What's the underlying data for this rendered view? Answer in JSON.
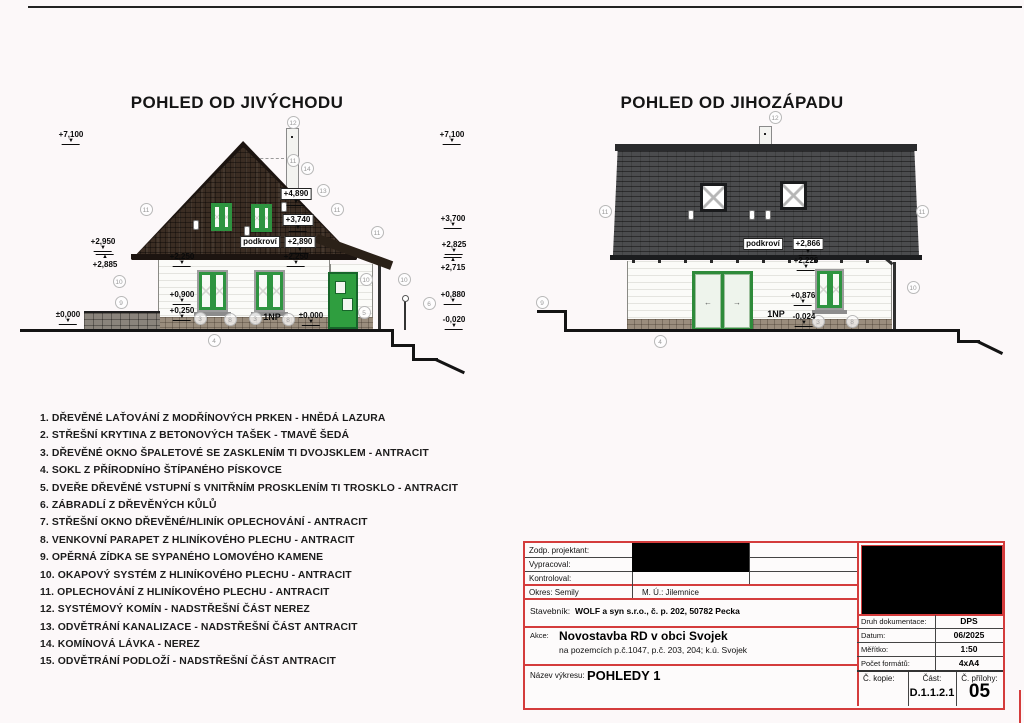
{
  "page": {
    "accent_red": "#d43c3c",
    "roof_brown": "#3b2d23",
    "roof_grey": "#4b4c4e",
    "window_green": "#2e9440"
  },
  "views": {
    "left": {
      "title": "POHLED OD JIVÝCHODU",
      "marks": [
        {
          "t": "+7,100",
          "x": 71,
          "y": 130,
          "d": "down"
        },
        {
          "t": "+7,100",
          "x": 452,
          "y": 130,
          "d": "down"
        },
        {
          "t": "+2,950",
          "x": 103,
          "y": 237,
          "d": "down"
        },
        {
          "t": "+2,885",
          "x": 105,
          "y": 254,
          "d": "up"
        },
        {
          "t": "±0,000",
          "x": 68,
          "y": 310,
          "d": "down"
        },
        {
          "t": "+3,700",
          "x": 453,
          "y": 214,
          "d": "down"
        },
        {
          "t": "+2,825",
          "x": 454,
          "y": 240,
          "d": "down"
        },
        {
          "t": "+2,715",
          "x": 453,
          "y": 257,
          "d": "up"
        },
        {
          "t": "+0,880",
          "x": 453,
          "y": 290,
          "d": "down"
        },
        {
          "t": "-0,020",
          "x": 454,
          "y": 315,
          "d": "down"
        },
        {
          "t": "+4,890",
          "x": 296,
          "y": 188,
          "d": "down",
          "box": 1
        },
        {
          "t": "+3,740",
          "x": 298,
          "y": 214,
          "d": "down",
          "box": 1
        },
        {
          "t": "podkroví",
          "x": 260,
          "y": 236,
          "box": 1
        },
        {
          "t": "+2,890",
          "x": 300,
          "y": 236,
          "d": "down",
          "box": 1
        },
        {
          "t": "+2,250",
          "x": 182,
          "y": 252,
          "d": "down"
        },
        {
          "t": "+2,250",
          "x": 296,
          "y": 252,
          "d": "down"
        },
        {
          "t": "+0,900",
          "x": 182,
          "y": 290,
          "d": "down"
        },
        {
          "t": "+0,250",
          "x": 182,
          "y": 306,
          "d": "down"
        },
        {
          "t": "±0,000",
          "x": 311,
          "y": 311,
          "d": "down"
        },
        {
          "t": "1NP",
          "x": 272,
          "y": 313,
          "bold": 1
        }
      ],
      "circles": [
        {
          "n": 12,
          "x": 293,
          "y": 122
        },
        {
          "n": 11,
          "x": 293,
          "y": 160
        },
        {
          "n": 14,
          "x": 307,
          "y": 168
        },
        {
          "n": 13,
          "x": 323,
          "y": 190
        },
        {
          "n": 11,
          "x": 146,
          "y": 209
        },
        {
          "n": 11,
          "x": 337,
          "y": 209
        },
        {
          "n": 11,
          "x": 377,
          "y": 232
        },
        {
          "n": 10,
          "x": 119,
          "y": 281
        },
        {
          "n": 10,
          "x": 366,
          "y": 279
        },
        {
          "n": 10,
          "x": 404,
          "y": 279
        },
        {
          "n": 9,
          "x": 121,
          "y": 302
        },
        {
          "n": 3,
          "x": 200,
          "y": 318
        },
        {
          "n": 8,
          "x": 230,
          "y": 319
        },
        {
          "n": 3,
          "x": 255,
          "y": 318
        },
        {
          "n": 8,
          "x": 288,
          "y": 319
        },
        {
          "n": 4,
          "x": 214,
          "y": 340
        },
        {
          "n": 5,
          "x": 364,
          "y": 312
        },
        {
          "n": 6,
          "x": 429,
          "y": 303
        }
      ]
    },
    "right": {
      "title": "POHLED OD JIHOZÁPADU",
      "marks": [
        {
          "t": "podkroví",
          "x": 763,
          "y": 238,
          "box": 1
        },
        {
          "t": "+2,866",
          "x": 808,
          "y": 238,
          "d": "down",
          "box": 1
        },
        {
          "t": "+2,226",
          "x": 806,
          "y": 256,
          "d": "down"
        },
        {
          "t": "+0,876",
          "x": 803,
          "y": 291,
          "d": "down"
        },
        {
          "t": "1NP",
          "x": 776,
          "y": 310,
          "bold": 1
        },
        {
          "t": "-0,024",
          "x": 804,
          "y": 312,
          "d": "down"
        }
      ],
      "circles": [
        {
          "n": 12,
          "x": 775,
          "y": 117
        },
        {
          "n": 11,
          "x": 605,
          "y": 211
        },
        {
          "n": 11,
          "x": 922,
          "y": 211
        },
        {
          "n": 10,
          "x": 913,
          "y": 287
        },
        {
          "n": 9,
          "x": 542,
          "y": 302
        },
        {
          "n": 4,
          "x": 660,
          "y": 341
        },
        {
          "n": 3,
          "x": 818,
          "y": 321
        },
        {
          "n": 8,
          "x": 852,
          "y": 321
        }
      ]
    }
  },
  "icons": {
    "slide_left_arrow": "←",
    "slide_right_arrow": "→"
  },
  "legend": {
    "items": [
      "1. DŘEVĚNÉ LAŤOVÁNÍ Z MODŘÍNOVÝCH PRKEN - HNĚDÁ LAZURA",
      "2. STŘEŠNÍ KRYTINA Z BETONOVÝCH TAŠEK - TMAVĚ ŠEDÁ",
      "3. DŘEVĚNÉ OKNO ŠPALETOVÉ SE ZASKLENÍM TI DVOJSKLEM - ANTRACIT",
      "4. SOKL Z PŘÍRODNÍHO ŠTÍPANÉHO PÍSKOVCE",
      "5. DVEŘE DŘEVĚNÉ VSTUPNÍ S VNITŘNÍM PROSKLENÍM TI TROSKLO - ANTRACIT",
      "6. ZÁBRADLÍ Z DŘEVĚNÝCH KŮLŮ",
      "7. STŘEŠNÍ OKNO DŘEVĚNÉ/HLINÍK OPLECHOVÁNÍ - ANTRACIT",
      "8. VENKOVNÍ PARAPET Z HLINÍKOVÉHO PLECHU - ANTRACIT",
      "9. OPĚRNÁ ZÍDKA SE SYPANÉHO LOMOVÉHO KAMENE",
      "10. OKAPOVÝ SYSTÉM Z HLINÍKOVÉHO PLECHU - ANTRACIT",
      "11. OPLECHOVÁNÍ Z HLINÍKOVÉHO PLECHU - ANTRACIT",
      "12. SYSTÉMOVÝ KOMÍN - NADSTŘEŠNÍ ČÁST NEREZ",
      "13. ODVĚTRÁNÍ KANALIZACE - NADSTŘEŠNÍ ČÁST ANTRACIT",
      "14. KOMÍNOVÁ LÁVKA - NEREZ",
      "15. ODVĚTRÁNÍ PODLOŽÍ - NADSTŘEŠNÍ ČÁST ANTRACIT"
    ]
  },
  "titleblock": {
    "zodp_label": "Zodp. projektant:",
    "vypracoval_label": "Vypracoval:",
    "kontroloval_label": "Kontroloval:",
    "okres": "Okres: Semily",
    "mu": "M. Ú.: Jilemnice",
    "stavebnik_label": "Stavebník:",
    "stavebnik_value": "WOLF a syn s.r.o., č. p. 202, 50782 Pecka",
    "akce_label": "Akce:",
    "akce_value": "Novostavba RD v obci Svojek",
    "akce_sub": "na pozemcích p.č.1047, p.č. 203, 204; k.ú. Svojek",
    "nazev_label": "Název výkresu:",
    "nazev_value": "POHLEDY 1",
    "druh_label": "Druh dokumentace:",
    "druh_value": "DPS",
    "datum_label": "Datum:",
    "datum_value": "06/2025",
    "meritko_label": "Měřítko:",
    "meritko_value": "1:50",
    "pocet_label": "Počet formátů:",
    "pocet_value": "4xA4",
    "kopie_label": "Č. kopie:",
    "cast_label": "Část:",
    "prilohy_label": "Č. přílohy:",
    "cast_value": "D.1.1.2.1",
    "prilohy_value": "05"
  }
}
